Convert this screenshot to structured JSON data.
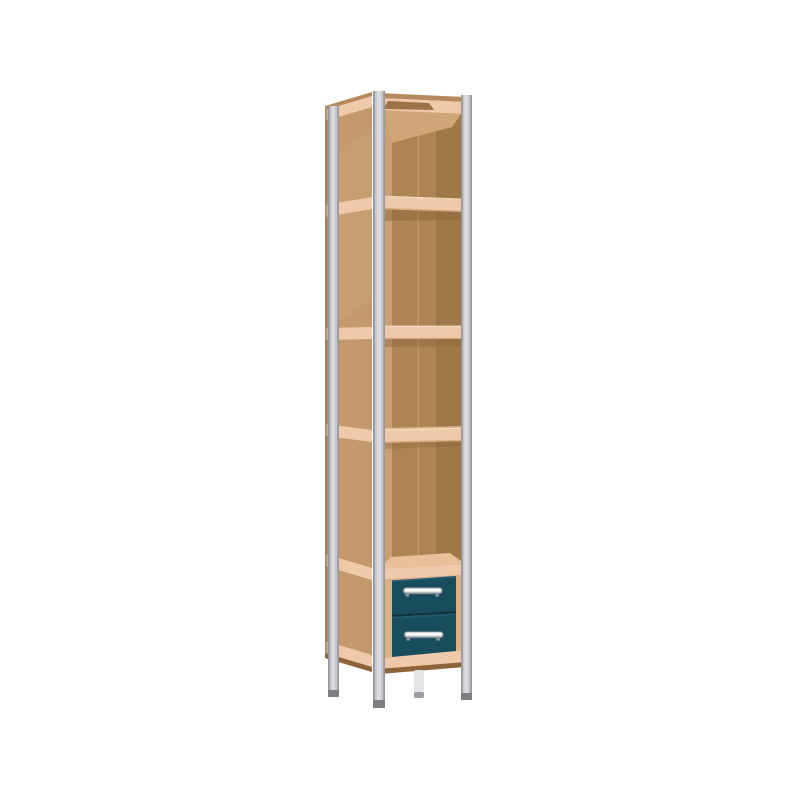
{
  "scene": {
    "description": "3D product render of a tall narrow storage shelf: light gray metal corner posts, wooden (MDF) panels and shelf edges, four open compartments, open top tray, and a two-drawer unit with dark petrol-blue drawer fronts and metal bow handles, standing on four slim legs",
    "background_color": "#ffffff",
    "compartment_count": 4,
    "drawer_count": 2,
    "handle_count": 2,
    "leg_count": 4,
    "parts": [
      "metal corner posts",
      "wooden side panel",
      "wooden shelf edge bands",
      "open compartments with back panel",
      "top tray opening",
      "two petrol-blue drawers",
      "metal bow handles",
      "four slim metal legs"
    ]
  },
  "colors": {
    "background": "#ffffff",
    "post_metal_mid": "#c6c7ca",
    "post_metal_light": "#dadbdd",
    "post_metal_edge": "#97989c",
    "post_foot": "#7e7f83",
    "back_leg": "#e4e5e7",
    "back_leg_foot": "#9b9ca0",
    "side_panel": "#c49a6c",
    "side_panel_light": "#cda579",
    "panel_back_edge": "#8f6a42",
    "shelf_edge": "#eecaaa",
    "shelf_edge_dark": "#c9976c",
    "shelf_edge_highlight": "#f4dcc2",
    "top_surface": "#b68a5c",
    "top_opening": "#9c7346",
    "interior_back": "#ae8455",
    "interior_right": "#a07848",
    "interior_left": "#cb9f70",
    "interior_seam": "#c59a6c",
    "interior_corner": "#8f6a3e",
    "interior_light_wash": "#d0a678",
    "shelf_shadow": "#8a6136",
    "shelf_floor": "#eac09b",
    "drawer_front": "#184d5e",
    "drawer_front_edge": "#2a6375",
    "drawer_divider": "#0d3440",
    "drawer_frame": "#dcb184",
    "bottom_shadow_strip": "#8d6439",
    "handle_top": "#fafafa",
    "handle_bottom": "#b4b9bd",
    "handle_outline": "#5f6d75",
    "handle_stem": "#8f9aa0"
  }
}
